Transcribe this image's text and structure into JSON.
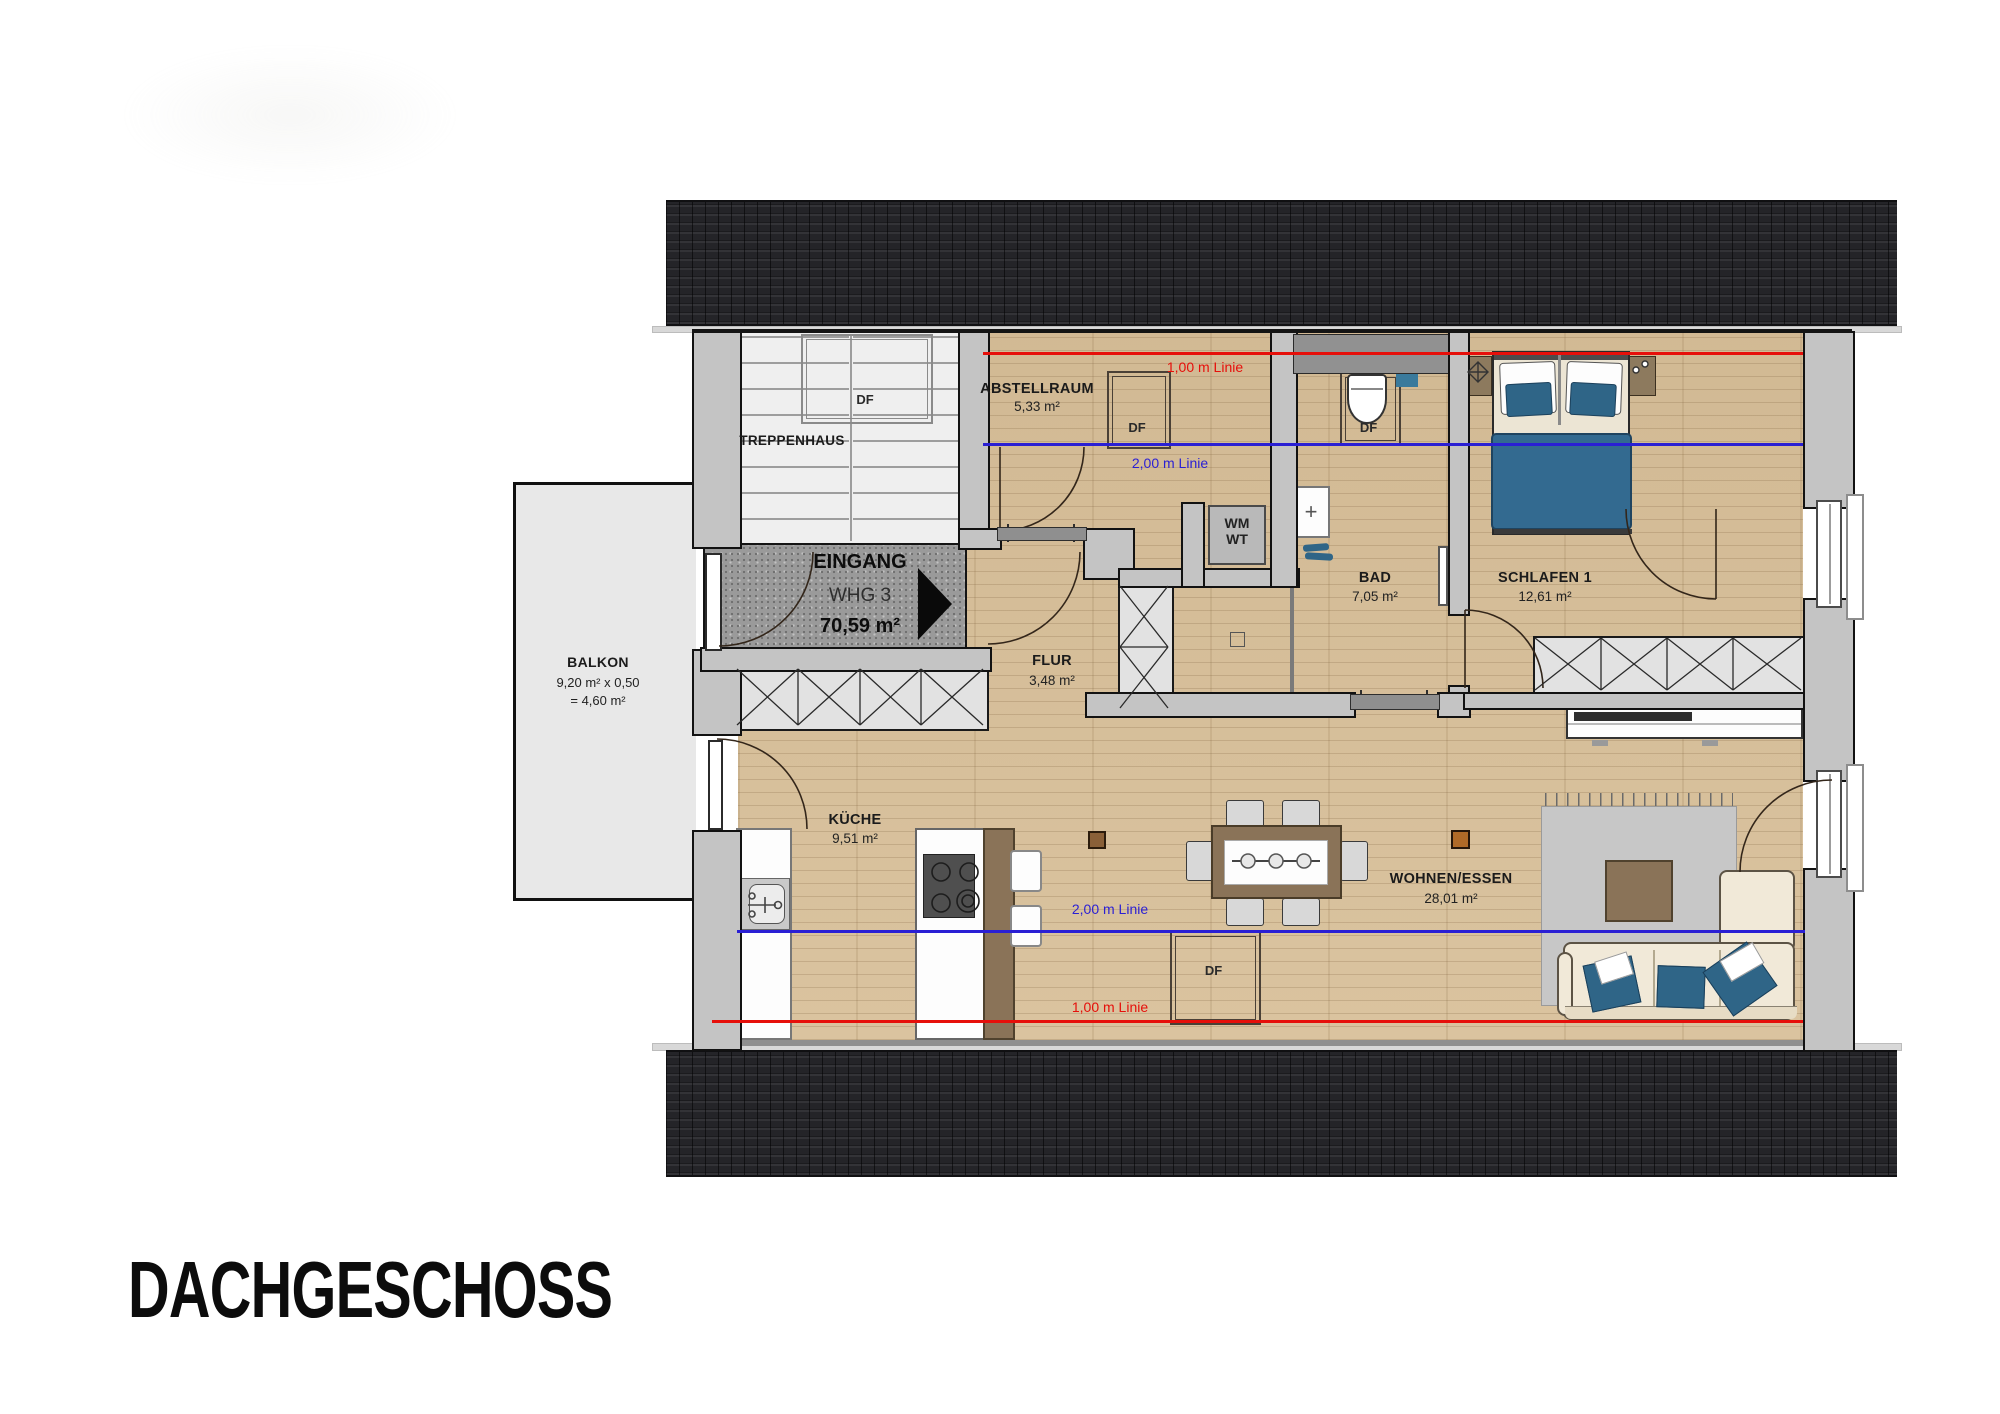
{
  "page": {
    "title": "DACHGESCHOSS"
  },
  "rooms": {
    "treppenhaus": {
      "name": "TREPPENHAUS"
    },
    "abstellraum": {
      "name": "ABSTELLRAUM",
      "area": "5,33 m²"
    },
    "eingang": {
      "title": "EINGANG",
      "unit": "WHG 3",
      "area": "70,59 m²"
    },
    "flur": {
      "name": "FLUR",
      "area": "3,48 m²"
    },
    "bad": {
      "name": "BAD",
      "area": "7,05 m²"
    },
    "schlafen1": {
      "name": "SCHLAFEN 1",
      "area": "12,61 m²"
    },
    "balkon": {
      "name": "BALKON",
      "calc": "9,20 m² x 0,50",
      "total": "= 4,60 m²"
    },
    "kueche": {
      "name": "KÜCHE",
      "area": "9,51 m²"
    },
    "wohnen_essen": {
      "name": "WOHNEN/ESSEN",
      "area": "28,01 m²"
    }
  },
  "labels": {
    "roof_window": "DF"
  },
  "appliances": {
    "washing_machine": "WM",
    "dryer": "WT"
  },
  "height_lines": {
    "one_meter": {
      "label": "1,00 m Linie",
      "color": "#e60f0a"
    },
    "two_meter": {
      "label": "2,00 m Linie",
      "color": "#2a1fd4"
    }
  },
  "colors": {
    "roof": "#242428",
    "floor_wood": "#d8c09a",
    "wall_fill": "#c4c4c4",
    "balcony_fill": "#e8e8e8",
    "entrance_concrete": "#9a9a9a",
    "furniture_accent_blue": "#2f6587"
  }
}
